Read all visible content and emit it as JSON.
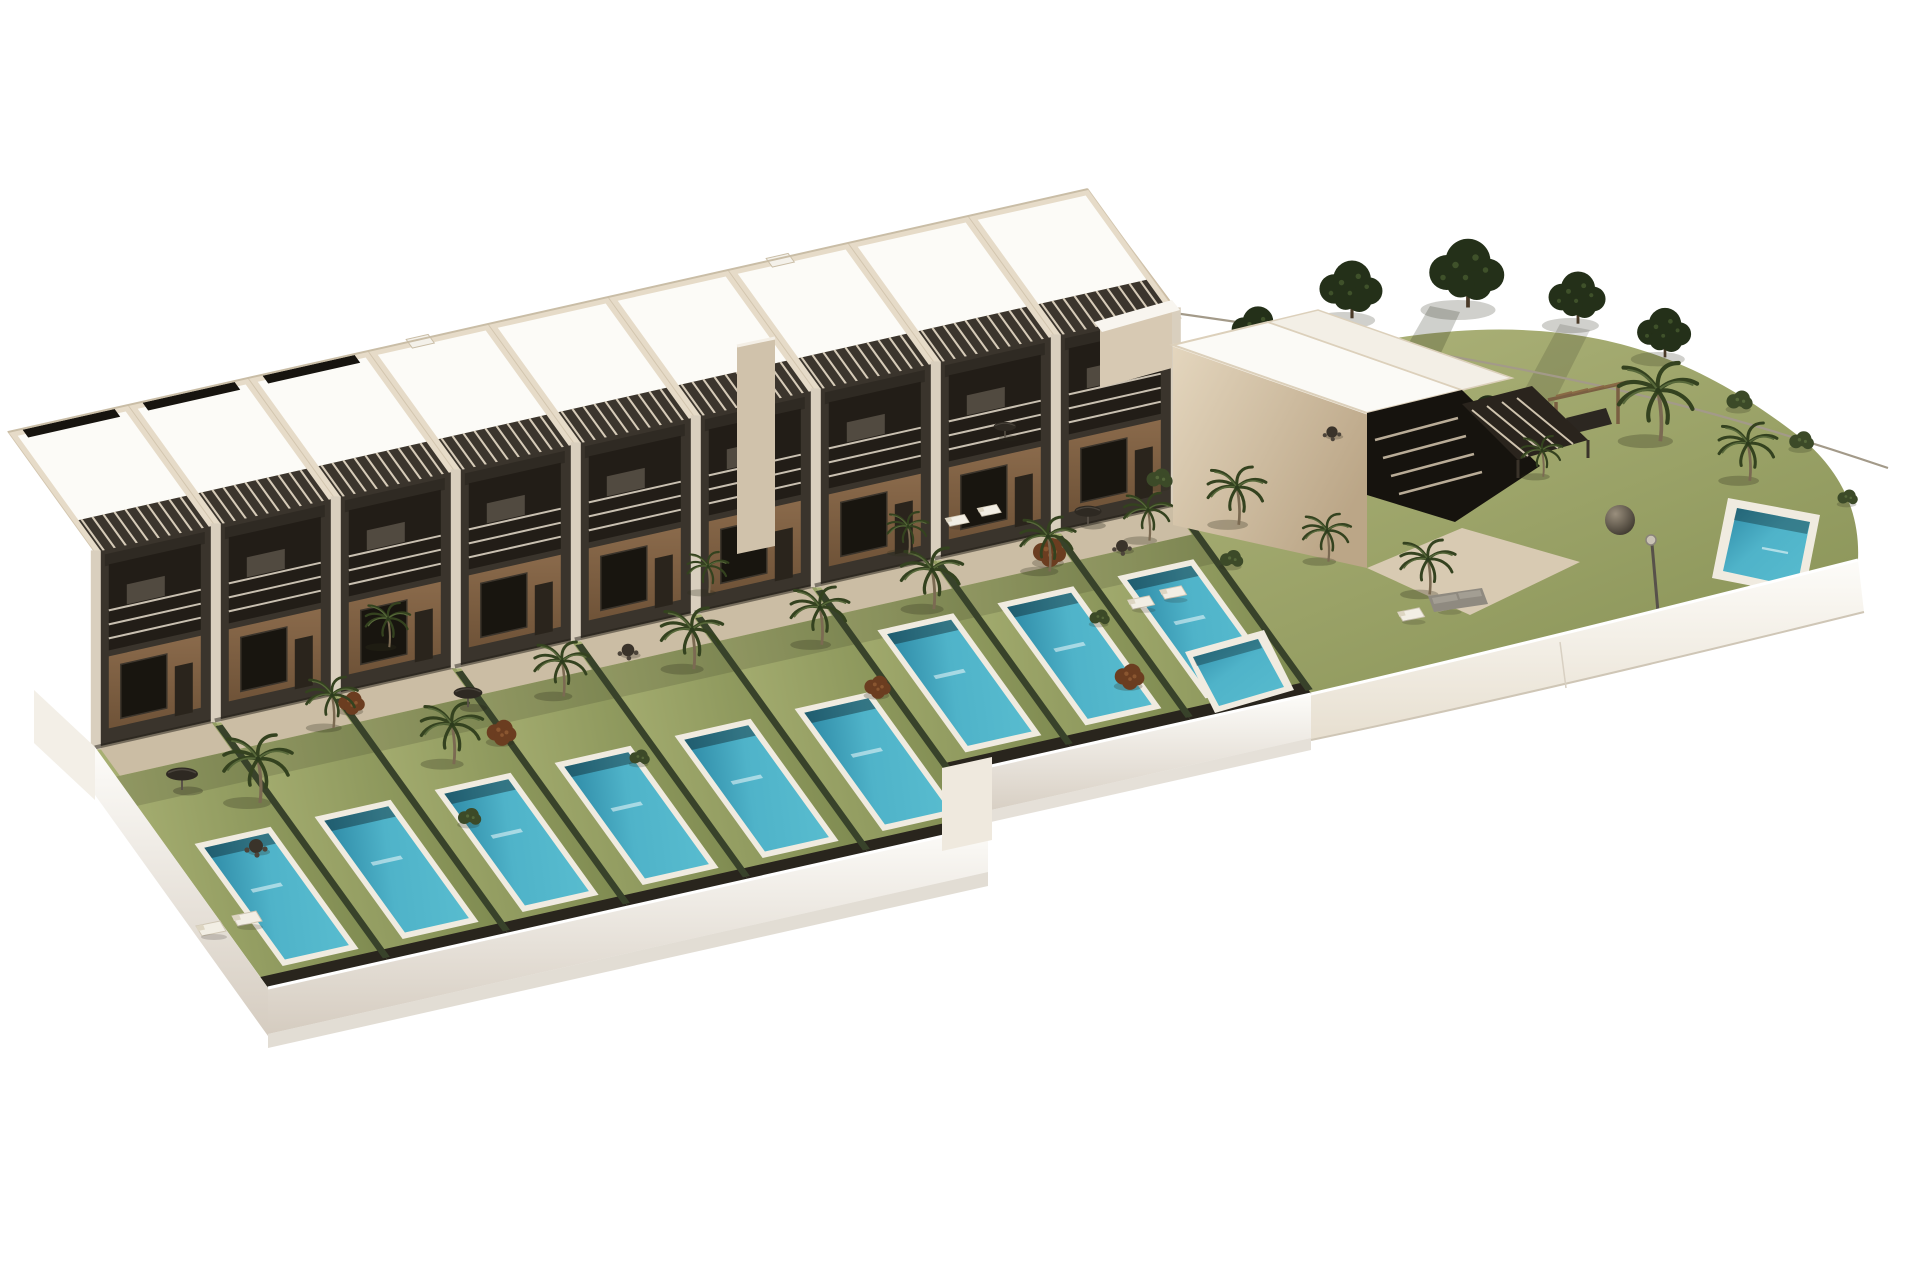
{
  "meta": {
    "title": "Aerial 3D architectural rendering of a modern two-storey townhouse development with private gardens and swimming pools, a detached villa and a communal landscaped garden on a white base",
    "image_type": "architectural-render",
    "background": "#ffffff"
  },
  "palette": {
    "background": "#ffffff",
    "roof_white": "#fcfbf7",
    "parapet_beige": "#e6dbc8",
    "wall_beige": "#cfc0a8",
    "wall_beige_dark": "#b5a488",
    "pier_light": "#d9cfbe",
    "wood": "#8a6a4b",
    "wood_dark": "#6f5338",
    "dark_structure": "#26211b",
    "recess_dark": "#221d17",
    "slat_light": "#d6cbb8",
    "lawn": "#98a368",
    "lawn_dark": "#7e8a50",
    "hedge": "#38422a",
    "tree_dark": "#243019",
    "palm_green": "#34421f",
    "pool_teal": "#4fb3c9",
    "pool_teal_dark": "#2e8aa6",
    "pool_coping": "#f0ebe0",
    "plinth_white": "#f6f2ea",
    "plinth_shade": "#d9d1c3",
    "terrace": "#cbbda4",
    "rim_shadow": "#29251d",
    "rust_bush": "#6b3d20",
    "fence_line": "#a39a89"
  },
  "scene": {
    "row": {
      "units": 9,
      "plot_width": 120,
      "left_plots": 6,
      "left_garden_depth": 280,
      "right_garden_depth": 220,
      "facade_height": 195,
      "solar_bays": [
        0,
        1,
        2
      ],
      "vent_bays": [
        3,
        6
      ]
    },
    "pools": {
      "private_count": 9,
      "villa_count": 1,
      "communal_count": 1
    },
    "palms": [
      [
        258,
        795,
        1.0
      ],
      [
        332,
        722,
        0.75
      ],
      [
        452,
        757,
        0.9
      ],
      [
        562,
        690,
        0.8
      ],
      [
        692,
        662,
        0.9
      ],
      [
        708,
        588,
        0.6
      ],
      [
        820,
        638,
        0.85
      ],
      [
        932,
        602,
        0.9
      ],
      [
        1048,
        565,
        0.8
      ],
      [
        1148,
        535,
        0.7
      ],
      [
        1237,
        518,
        0.85
      ],
      [
        1327,
        556,
        0.7
      ],
      [
        1428,
        588,
        0.8
      ],
      [
        1658,
        432,
        1.15
      ],
      [
        1748,
        474,
        0.85
      ],
      [
        1542,
        472,
        0.6
      ],
      [
        908,
        548,
        0.6
      ],
      [
        388,
        642,
        0.65
      ]
    ],
    "dark_trees": [
      [
        1258,
        348,
        0.85
      ],
      [
        1352,
        312,
        1.05
      ],
      [
        1468,
        300,
        1.25
      ],
      [
        1578,
        318,
        0.95
      ],
      [
        1210,
        378,
        0.6
      ],
      [
        1665,
        352,
        0.9
      ],
      [
        1488,
        432,
        0.75
      ]
    ],
    "rust_bushes": [
      [
        1050,
        556,
        1.0
      ],
      [
        1130,
        680,
        0.9
      ],
      [
        502,
        736,
        0.9
      ],
      [
        352,
        706,
        0.8
      ],
      [
        878,
        690,
        0.8
      ]
    ],
    "green_bushes": [
      [
        1160,
        482,
        0.9
      ],
      [
        1232,
        562,
        0.8
      ],
      [
        1740,
        404,
        0.9
      ],
      [
        1802,
        444,
        0.85
      ],
      [
        1848,
        500,
        0.7
      ],
      [
        470,
        820,
        0.8
      ],
      [
        640,
        760,
        0.7
      ],
      [
        1100,
        620,
        0.7
      ]
    ],
    "umbrellas": [
      [
        182,
        782,
        1.0
      ],
      [
        468,
        700,
        0.9
      ],
      [
        1088,
        518,
        0.85
      ],
      [
        1005,
        432,
        0.7
      ]
    ],
    "tables": [
      [
        256,
        846,
        1.0
      ],
      [
        628,
        650,
        0.9
      ],
      [
        1122,
        546,
        0.85
      ],
      [
        1332,
        432,
        0.8
      ]
    ],
    "loungers": [
      [
        212,
        928,
        1.0
      ],
      [
        248,
        918,
        1.0
      ],
      [
        1142,
        602,
        0.9
      ],
      [
        1174,
        592,
        0.9
      ],
      [
        1412,
        614,
        0.9
      ],
      [
        1448,
        604,
        0.9
      ],
      [
        958,
        520,
        0.8
      ],
      [
        990,
        510,
        0.8
      ]
    ],
    "gray_sofas": [
      [
        1456,
        602,
        1.0
      ]
    ]
  }
}
